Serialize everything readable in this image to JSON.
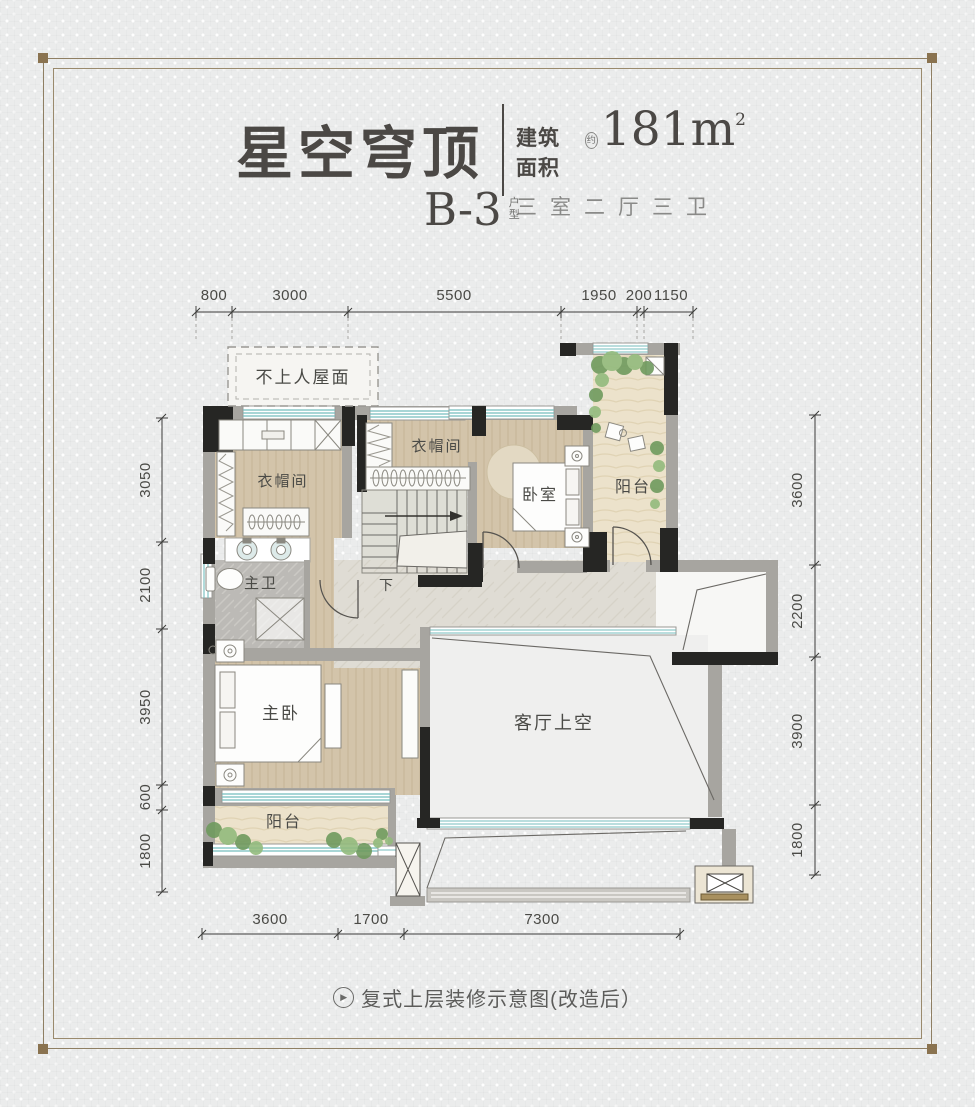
{
  "header": {
    "title": "星空穹顶",
    "area_label": "建筑面积",
    "approx": "约",
    "area_value": "181m",
    "area_sup": "2",
    "rooms_line": "三室二厅三卫",
    "unit_code": "B-3",
    "unit_type_top": "户",
    "unit_type_bottom": "型"
  },
  "plan": {
    "labels": {
      "roof": "不上人屋面",
      "cloak_left": "衣帽间",
      "cloak_top": "衣帽间",
      "bedroom": "卧室",
      "balcony_top": "阳台",
      "master_bath": "主卫",
      "master_bedroom": "主卧",
      "balcony_bottom": "阳台",
      "living_void": "客厅上空",
      "stairs_down": "下"
    },
    "dimensions": {
      "top": [
        "800",
        "3000",
        "5500",
        "1950",
        "200",
        "1150"
      ],
      "left": [
        "3050",
        "2100",
        "3950",
        "600",
        "1800"
      ],
      "right": [
        "3600",
        "2200",
        "3900",
        "1800"
      ],
      "bottom": [
        "3600",
        "1700",
        "7300"
      ]
    }
  },
  "caption": {
    "icon_glyph": "▶",
    "text": "复式上层装修示意图(改造后）"
  },
  "colors": {
    "frame": "#8f7f63",
    "wall_black": "#262624",
    "wall_gray": "#a7a5a0",
    "wood": "#d3c4aa",
    "marble": "#dfdcd4",
    "window_teal": "#74bdbd",
    "greenery": "#6f9a5e",
    "text": "#4b4845"
  }
}
